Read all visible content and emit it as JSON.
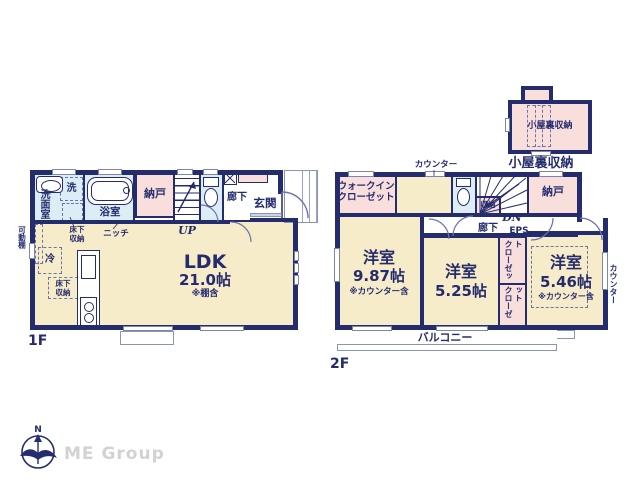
{
  "colors": {
    "wall_navy": "#252c6e",
    "room_cream": "#f7ecca",
    "storage_pink": "#f9dfdc",
    "wet_blue": "#dcedf6",
    "brand_gray": "#d2d2d2"
  },
  "floor1": {
    "label": "1F",
    "washroom": "洗面室",
    "washer": "洗",
    "bathroom": "浴室",
    "storage": "納戸",
    "stairs": "UP",
    "hallway": "廊下",
    "entrance": "玄関",
    "underfloor_storage_bath": "床下\n収納",
    "niche": "ニッチ",
    "movable_shelf": "可動棚",
    "fridge": "冷",
    "underfloor_storage_kitchen": "床下\n収納",
    "ldk": {
      "name": "LDK",
      "size": "21.0帖",
      "note": "※棚含"
    }
  },
  "floor2": {
    "label": "2F",
    "counter_top": "カウンター",
    "walkin_closet": "ウォークイン\nクローゼット",
    "storage_small": "収納",
    "stairs": "DN",
    "hallway": "廊下",
    "eps": "EPS",
    "storage": "納戸",
    "room_a": {
      "name": "洋室",
      "size": "9.87帖",
      "note": "※カウンター含"
    },
    "room_b": {
      "name": "洋室",
      "size": "5.25帖"
    },
    "room_c": {
      "name": "洋室",
      "size": "5.46帖",
      "note": "※カウンター含"
    },
    "closet_a": "クローゼット",
    "closet_b": "クローゼット",
    "counter_side": "カウンター",
    "balcony": "バルコニー"
  },
  "attic": {
    "room_label": "小屋裏収納",
    "caption": "小屋裏収納"
  },
  "footer": {
    "brand": "ME Group",
    "compass_north": "N"
  }
}
